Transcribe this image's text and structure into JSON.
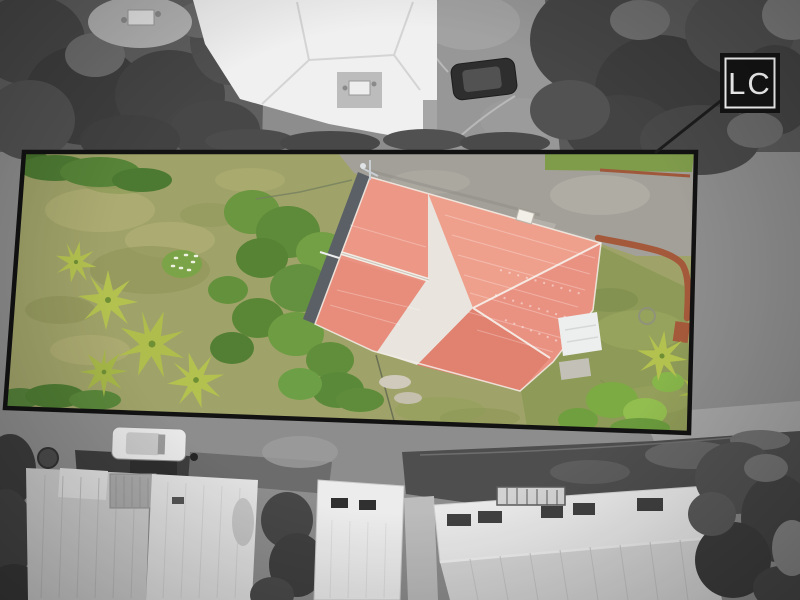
{
  "scene": {
    "kind": "aerial-property-photograph",
    "logo": {
      "text": "LC",
      "bg": "#141414",
      "border": "#ffffff",
      "fg": "#ffffff"
    },
    "palette": {
      "outside_base": "#8d8d8d",
      "boundary": "#121212",
      "leader_line": "#1c1c1c",
      "field_grass": "#a0a369",
      "lawn_green": "#8e9a57",
      "shrub_green": "#5f8c39",
      "fern_green": "#b3c14f",
      "driveway_warm": "#a3a099",
      "brick_wall": "#a5593b",
      "roof_salmon": "#eb9383",
      "roof_salmon_light": "#efa08d",
      "roof_salmon_dark": "#e18170",
      "roof_gray_section": "#e9e5de",
      "roof_ridge_white": "#f6f2ec",
      "lean_to_gray": "#5a6066",
      "porch_white": "#ecefee",
      "neighbor_roof_white": "#f0f0f0",
      "road_dark": "#4e4e4e"
    }
  }
}
